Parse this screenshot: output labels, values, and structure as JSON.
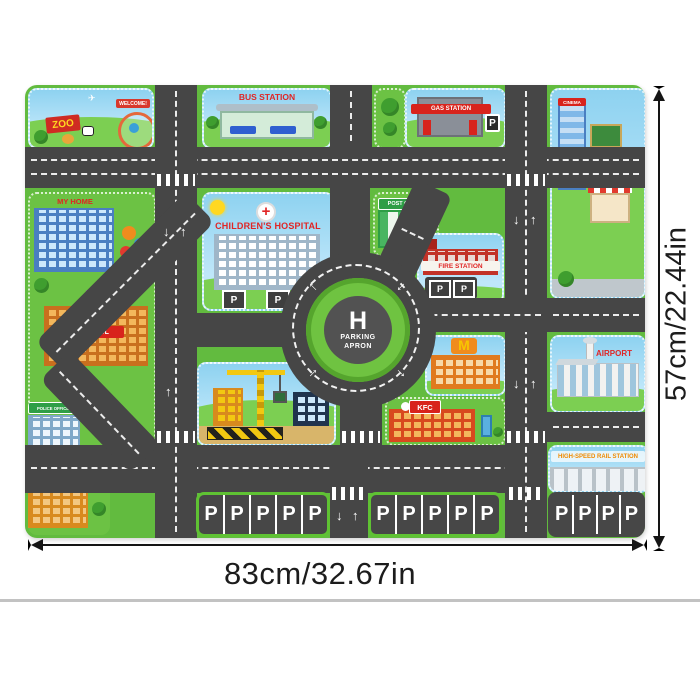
{
  "mat": {
    "labels": {
      "zoo": "ZOO",
      "welcome": "WELCOME!",
      "bus_station": "BUS STATION",
      "gas_station": "GAS STATION",
      "cinema": "CINEMA",
      "my_home": "MY HOME",
      "school": "SCHOOL",
      "hospital": "CHILDREN'S HOSPITAL",
      "hospital_cross": "+",
      "post_office": "POST OFFICE",
      "fire_station": "FIRE STATION",
      "police_office": "POLICE OFFICE",
      "mcdonalds_m": "M",
      "kfc": "KFC",
      "airport": "AIRPORT",
      "rail_station": "HIGH-SPEED RAIL STATION",
      "helipad_h": "H",
      "helipad_line1": "PARKING",
      "helipad_line2": "APRON",
      "stall": "P"
    },
    "colors": {
      "road": "#464646",
      "grass": "#62bb3f",
      "sky": "#8ed2f0",
      "accent_red": "#e02525",
      "lot_border": "#5fc233"
    }
  },
  "icons": {
    "arrow_up": "↑",
    "arrow_down": "↓",
    "arrow_left": "←",
    "plane": "✈"
  },
  "dimensions": {
    "width_label": "83cm/32.67in",
    "height_label": "57cm/22.44in"
  }
}
